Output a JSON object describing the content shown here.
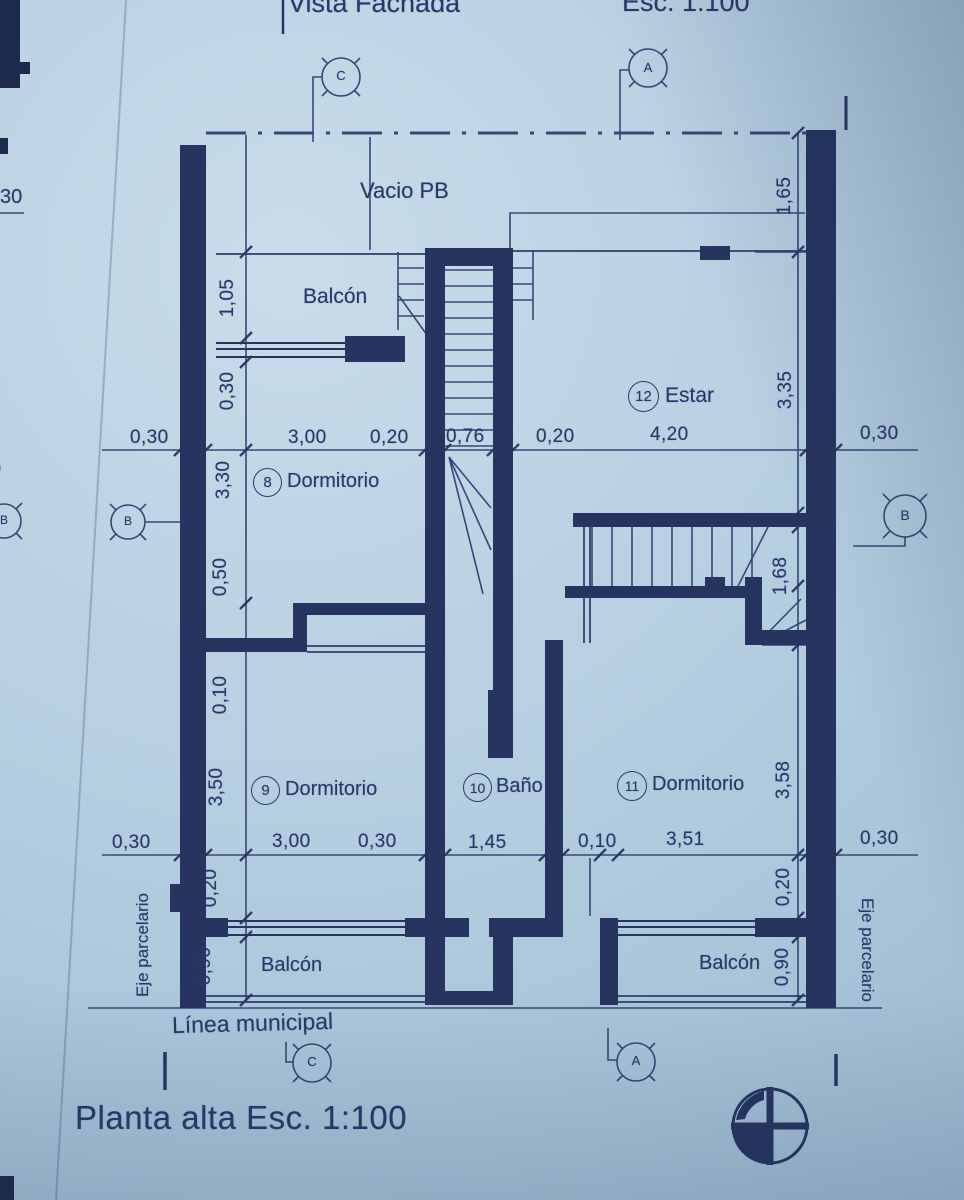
{
  "titles": {
    "top_left": "Vista Fachada",
    "top_right": "Esc. 1:100",
    "bottom": "Planta alta Esc. 1:100"
  },
  "edge_notes": {
    "left_top": "30",
    "left_mid": "0"
  },
  "plan": {
    "void_label": "Vacio PB",
    "balcony_top": "Balcón",
    "balcony_bottom_left": "Balcón",
    "balcony_bottom_right": "Balcón",
    "rooms": [
      {
        "number": "8",
        "name": "Dormitorio"
      },
      {
        "number": "9",
        "name": "Dormitorio"
      },
      {
        "number": "10",
        "name": "Baño"
      },
      {
        "number": "11",
        "name": "Dormitorio"
      },
      {
        "number": "12",
        "name": "Estar"
      }
    ],
    "property_line_left": "Eje parcelario",
    "property_line_right": "Eje parcelario",
    "municipal_line": "Línea municipal"
  },
  "dimensions": {
    "mid_row": [
      "0,30",
      "3,00",
      "0,20",
      "0,76",
      "0,20",
      "4,20",
      "0,30"
    ],
    "bottom_row": [
      "0,30",
      "3,00",
      "0,30",
      "1,45",
      "0,10",
      "3,51",
      "0,30"
    ],
    "left_col": [
      "1,05",
      "0,30",
      "3,30",
      "0,50",
      "0,10",
      "3,50",
      "0,20",
      "0,90"
    ],
    "right_col": [
      "1,65",
      "3,35",
      "1,68",
      "3,58",
      "0,20",
      "0,90"
    ]
  },
  "markers": {
    "top_left": "C",
    "top_right": "A",
    "left": "B",
    "left_edge": "B",
    "right": "B",
    "bottom_left": "C",
    "bottom_right": "A"
  },
  "colors": {
    "paper": "#b8d0e2",
    "ink": "#26345f"
  }
}
